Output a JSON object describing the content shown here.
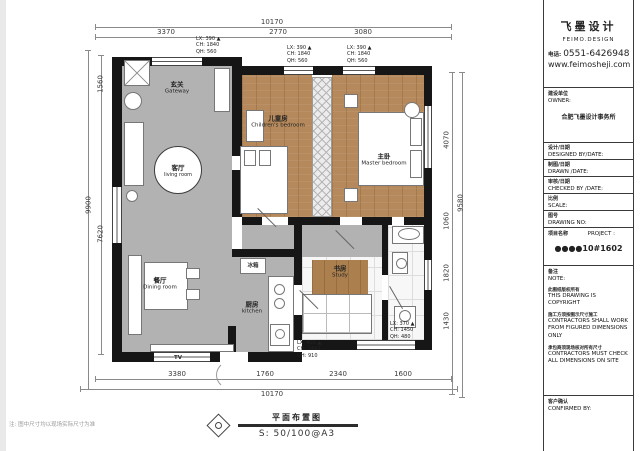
{
  "brand": {
    "name_cn": "飞墨设计",
    "name_en": "FEIMO.DESIGN",
    "phone_label": "电话:",
    "phone": "0551-6426948",
    "website": "www.feimosheji.com"
  },
  "titleblock": {
    "owner": {
      "cn": "建设单位",
      "en": "OWNER:",
      "value": "合肥飞墨设计事务所"
    },
    "fields": [
      {
        "cn": "设计/日期",
        "en": "DESIGNED BY/DATE:"
      },
      {
        "cn": "制图/日期",
        "en": "DRAWN /DATE:"
      },
      {
        "cn": "审核/日期",
        "en": "CHECKED BY /DATE:"
      },
      {
        "cn": "比例",
        "en": "SCALE:"
      },
      {
        "cn": "图号",
        "en": "DRAWING NO:"
      }
    ],
    "project": {
      "cn": "项目名称",
      "en": "PROJECT :",
      "value": "●●●●10#1602"
    },
    "note": {
      "cn": "备注",
      "en": "NOTE:",
      "items": [
        {
          "cn": "此图纸版权所有",
          "en": "THIS DRAWING IS COPYRIGHT"
        },
        {
          "cn": "施工方须按图示尺寸施工",
          "en": "CONTRACTORS SHALL WORK FROM FIGURED DIMENSIONS ONLY"
        },
        {
          "cn": "承包商须现场核对所有尺寸",
          "en": "CONTRACTORS MUST CHECK ALL DIMENSIONS ON SITE"
        }
      ]
    },
    "confirmed": {
      "cn": "客户确认",
      "en": "CONFIRMED BY:"
    }
  },
  "plan": {
    "rooms": [
      {
        "cn": "玄关",
        "en": "Gateway",
        "x": 177,
        "y": 88,
        "circle": false
      },
      {
        "cn": "客厅",
        "en": "living room",
        "x": 177,
        "y": 169,
        "circle": true
      },
      {
        "cn": "儿童房",
        "en": "Children's bedroom",
        "x": 278,
        "y": 122,
        "circle": false
      },
      {
        "cn": "主卧",
        "en": "Master bedroom",
        "x": 384,
        "y": 160,
        "circle": false
      },
      {
        "cn": "餐厅",
        "en": "Dining room",
        "x": 160,
        "y": 284,
        "circle": false
      },
      {
        "cn": "厨房",
        "en": "kitchen",
        "x": 252,
        "y": 308,
        "circle": false
      },
      {
        "cn": "书房",
        "en": "Study",
        "x": 340,
        "y": 272,
        "circle": false
      }
    ],
    "small_labels": [
      {
        "text": "TV",
        "x": 178,
        "y": 358
      },
      {
        "text": "冰箱",
        "x": 253,
        "y": 265
      }
    ],
    "window_tags": [
      {
        "lines": [
          "LX: 390 ▲",
          "CH: 1840",
          "QH: 560"
        ],
        "x": 196,
        "y": 36
      },
      {
        "lines": [
          "LX: 390 ▲",
          "CH: 1840",
          "QH: 560"
        ],
        "x": 287,
        "y": 45
      },
      {
        "lines": [
          "LX: 390 ▲",
          "CH: 1840",
          "QH: 560"
        ],
        "x": 347,
        "y": 45
      },
      {
        "lines": [
          "LX: 370 ▲",
          "CH: 1450",
          "QH: 480"
        ],
        "x": 390,
        "y": 321
      },
      {
        "lines": [
          "LX: 420 ▲",
          "CH: 1440",
          "QH: 910"
        ],
        "x": 297,
        "y": 340
      }
    ],
    "dim_labels": [
      {
        "text": "10170",
        "x": 272,
        "y": 26,
        "rot": 0
      },
      {
        "text": "3370",
        "x": 166,
        "y": 36,
        "rot": 0
      },
      {
        "text": "2770",
        "x": 278,
        "y": 36,
        "rot": 0
      },
      {
        "text": "3080",
        "x": 363,
        "y": 36,
        "rot": 0
      },
      {
        "text": "3380",
        "x": 177,
        "y": 378,
        "rot": 0
      },
      {
        "text": "1760",
        "x": 265,
        "y": 378,
        "rot": 0
      },
      {
        "text": "2340",
        "x": 338,
        "y": 378,
        "rot": 0
      },
      {
        "text": "1600",
        "x": 403,
        "y": 378,
        "rot": 0
      },
      {
        "text": "10170",
        "x": 272,
        "y": 398,
        "rot": 0
      },
      {
        "text": "9900",
        "x": 89,
        "y": 205,
        "rot": -90
      },
      {
        "text": "1560",
        "x": 101,
        "y": 84,
        "rot": -90
      },
      {
        "text": "7620",
        "x": 101,
        "y": 234,
        "rot": -90
      },
      {
        "text": "9580",
        "x": 461,
        "y": 203,
        "rot": -90
      },
      {
        "text": "4070",
        "x": 447,
        "y": 140,
        "rot": -90
      },
      {
        "text": "1060",
        "x": 447,
        "y": 221,
        "rot": -90
      },
      {
        "text": "1820",
        "x": 447,
        "y": 273,
        "rot": -90
      },
      {
        "text": "1430",
        "x": 447,
        "y": 321,
        "rot": -90
      }
    ]
  },
  "footer": {
    "title": "平面布置图",
    "scale": "S: 50/100@A3",
    "note": "注: 图中尺寸均以现场实际尺寸为准"
  }
}
